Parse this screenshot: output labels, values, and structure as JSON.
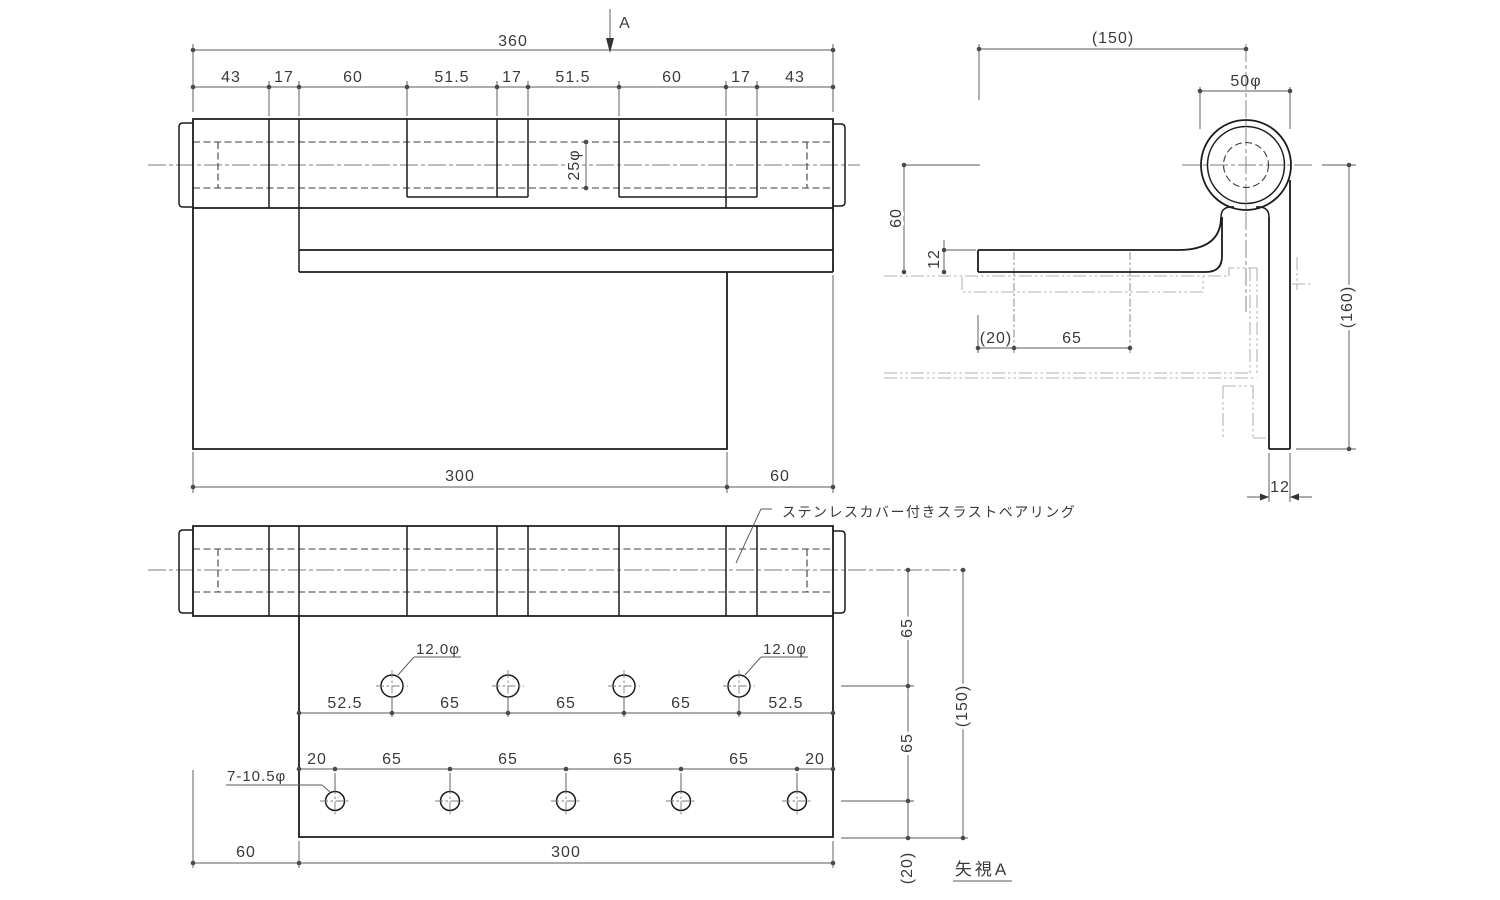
{
  "front_view": {
    "section_label": "A",
    "overall_width": "360",
    "segments": [
      "43",
      "17",
      "60",
      "51.5",
      "17",
      "51.5",
      "60",
      "17",
      "43"
    ],
    "pin_dia": "25φ",
    "plate_width": "300",
    "plate_offset": "60"
  },
  "side_view": {
    "reach": "(150)",
    "knuckle_dia": "50φ",
    "drop": "60",
    "arm_thickness": "12",
    "edge_offset": "(20)",
    "hole_pitch": "65",
    "leaf_length": "(160)",
    "leaf_thickness": "12"
  },
  "bottom_view": {
    "hole_label_1": "12.0φ",
    "hole_label_2": "12.0φ",
    "row1_dims": [
      "52.5",
      "65",
      "65",
      "65",
      "52.5"
    ],
    "row2_dims": [
      "20",
      "65",
      "65",
      "65",
      "65",
      "20"
    ],
    "hole_note": "7-10.5φ",
    "plate_offset": "60",
    "plate_width": "300",
    "side_dims": [
      "65",
      "65",
      "(150)",
      "(20)"
    ],
    "bearing_note": "ステンレスカバー付きスラストベアリング",
    "view_ref": "矢視A"
  }
}
